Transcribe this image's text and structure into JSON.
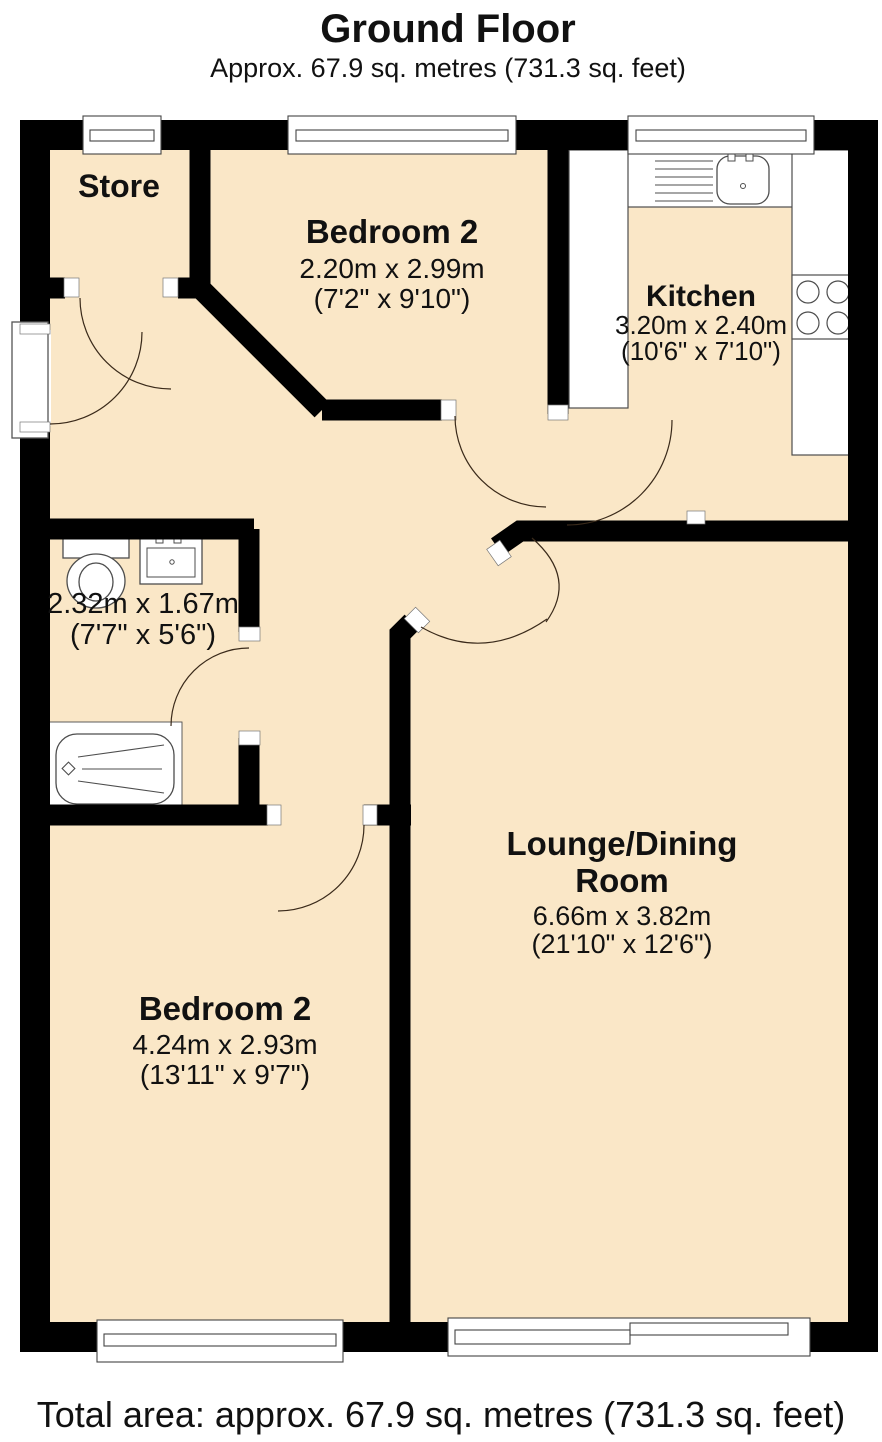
{
  "title": {
    "text": "Ground Floor",
    "subtitle": "Approx. 67.9 sq. metres (731.3 sq. feet)"
  },
  "rooms": {
    "store": {
      "name": "Store"
    },
    "bedroom2_top": {
      "name": "Bedroom 2",
      "metric": "2.20m x 2.99m",
      "imperial": "(7'2\" x 9'10\")"
    },
    "kitchen": {
      "name": "Kitchen",
      "metric": "3.20m x 2.40m",
      "imperial": "(10'6\" x 7'10\")"
    },
    "bathroom": {
      "metric": "2.32m x 1.67m",
      "imperial": "(7'7\" x 5'6\")"
    },
    "lounge": {
      "name_line1": "Lounge/Dining",
      "name_line2": "Room",
      "metric": "6.66m x 3.82m",
      "imperial": "(21'10\" x 12'6\")"
    },
    "bedroom2_bottom": {
      "name": "Bedroom 2",
      "metric": "4.24m x 2.93m",
      "imperial": "(13'11\" x 9'7\")"
    }
  },
  "footer": {
    "total_area": "Total area: approx. 67.9 sq. metres (731.3 sq. feet)"
  },
  "fixtures": [
    "window",
    "door-swing",
    "entrance-door",
    "kitchen-sink",
    "drainer",
    "hob-4-rings",
    "worktop",
    "toilet",
    "wash-basin",
    "bathtub",
    "patio-doors"
  ],
  "colors": {
    "floor": "#FAE7C7",
    "wall": "#000000",
    "fixture_outline": "#4d4d4d",
    "text": "#111111"
  }
}
